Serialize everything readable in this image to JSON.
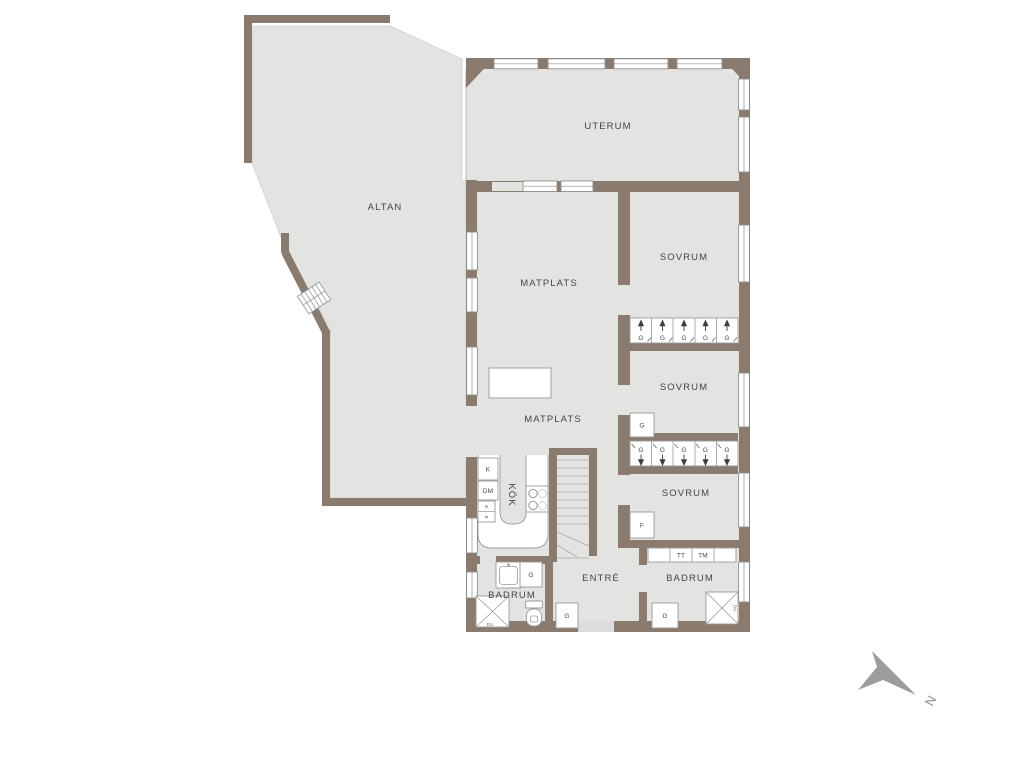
{
  "plan": {
    "type": "floor_plan",
    "rooms": {
      "uterum": "UTERUM",
      "altan": "ALTAN",
      "matplats_upper": "MATPLATS",
      "matplats_lower": "MATPLATS",
      "sovrum_1": "SOVRUM",
      "sovrum_2": "SOVRUM",
      "sovrum_3": "SOVRUM",
      "kok": "KÖK",
      "badrum_left": "BADRUM",
      "badrum_right": "BADRUM",
      "entre": "ENTRÉ"
    },
    "fixtures": {
      "wardrobe": "G",
      "fridge": "K",
      "dishwasher": "DM",
      "freezer": "F",
      "tumble_dryer": "TT",
      "washing_machine": "TM",
      "shower": "DU"
    },
    "compass": {
      "north": "N"
    },
    "colors": {
      "wall": "#8a7b6e",
      "floor": "#e3e3e2",
      "background": "#ffffff",
      "fixture_outline": "#9a9a9a",
      "label_text": "#454545",
      "north_arrow": "#9c9c9c"
    }
  }
}
